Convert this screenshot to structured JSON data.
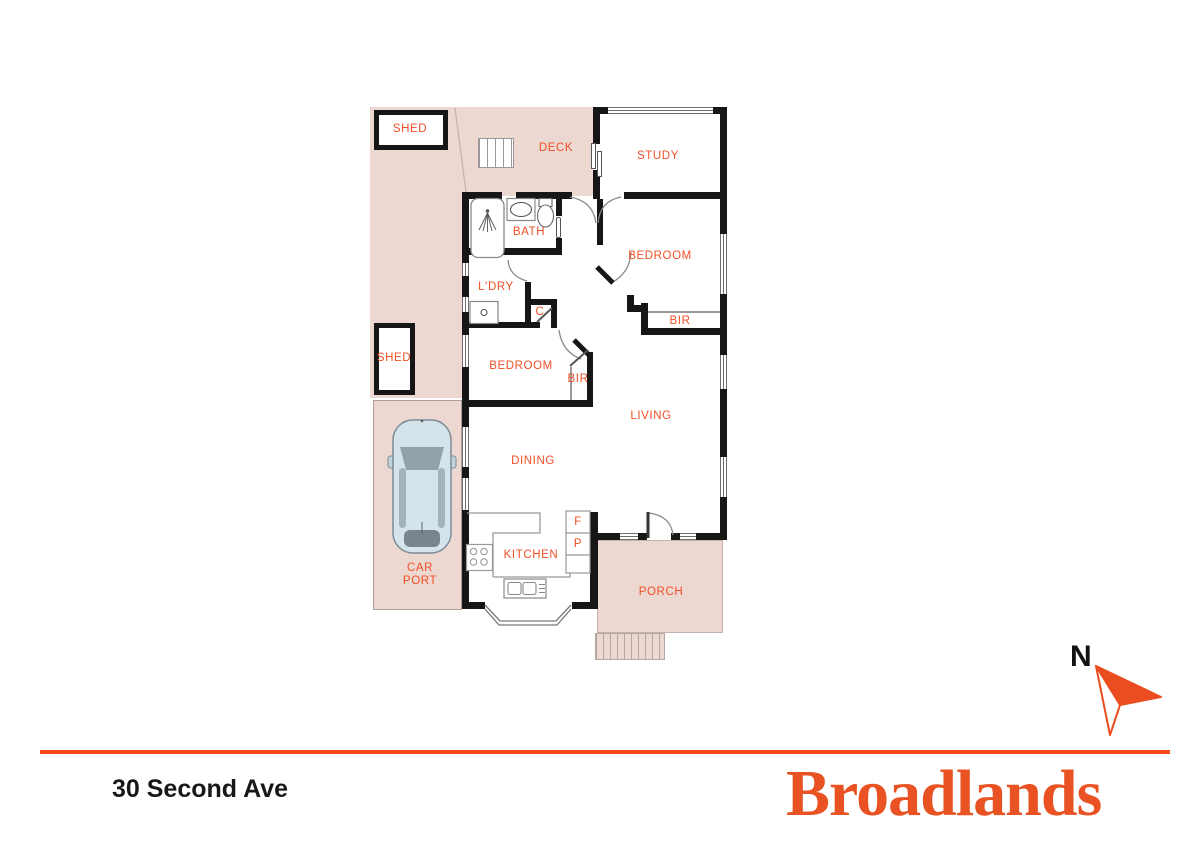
{
  "meta": {
    "address": "30 Second Ave",
    "brand": "Broadlands",
    "north_label": "N"
  },
  "floorplan": {
    "labels": {
      "shed_top": "SHED",
      "shed_side": "SHED",
      "deck": "DECK",
      "study": "STUDY",
      "bath": "BATH",
      "bedroom_rear": "BEDROOM",
      "bir_rear": "BIR",
      "laundry": "L'DRY",
      "cupboard": "C",
      "bedroom_front": "BEDROOM",
      "bir_front": "BIR",
      "living": "LIVING",
      "dining": "DINING",
      "kitchen": "KITCHEN",
      "fridge": "F",
      "pantry": "P",
      "carport_line1": "CAR",
      "carport_line2": "PORT",
      "porch": "PORCH"
    }
  },
  "colors": {
    "accent_orange": "#f2481a",
    "label_orange": "#f04f26",
    "brand_orange": "#e95222",
    "area_pink": "#ecd7d1",
    "wall_black": "#161616",
    "car_body_blue": "#d5e3eb"
  }
}
